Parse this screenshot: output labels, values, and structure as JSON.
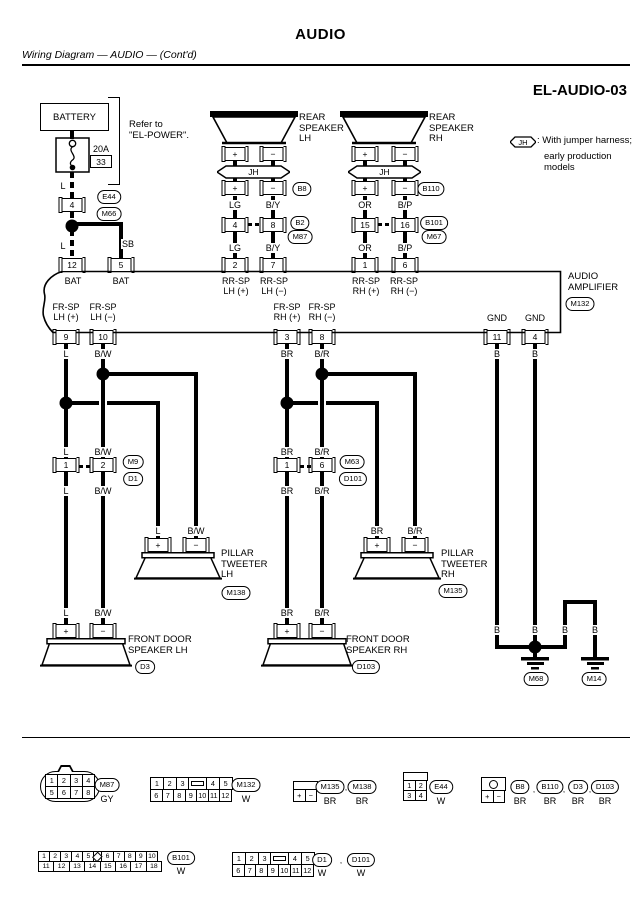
{
  "header": {
    "title": "AUDIO",
    "subtitle": "Wiring Diagram — AUDIO — (Cont'd)",
    "code": "EL-AUDIO-03"
  },
  "jh": {
    "label": "JH"
  },
  "battery": {
    "label": "BATTERY"
  },
  "graphics": {
    "wires": [
      [
        70,
        130,
        4,
        9
      ],
      [
        70,
        172,
        4,
        26,
        "vd"
      ],
      [
        70,
        212,
        4,
        14,
        "vd"
      ],
      [
        70,
        230,
        4,
        28,
        "vd"
      ],
      [
        70,
        222,
        53,
        4
      ],
      [
        119,
        222,
        4,
        36
      ],
      [
        233,
        161,
        4,
        5
      ],
      [
        271,
        161,
        4,
        5
      ],
      [
        233,
        178,
        4,
        4
      ],
      [
        271,
        178,
        4,
        4
      ],
      [
        233,
        196,
        4,
        22
      ],
      [
        271,
        196,
        4,
        22
      ],
      [
        233,
        232,
        4,
        26
      ],
      [
        271,
        232,
        4,
        26
      ],
      [
        248,
        223,
        4,
        3
      ],
      [
        255,
        223,
        4,
        3
      ],
      [
        363,
        161,
        4,
        5
      ],
      [
        403,
        161,
        4,
        5
      ],
      [
        363,
        178,
        4,
        4
      ],
      [
        403,
        178,
        4,
        4
      ],
      [
        363,
        196,
        4,
        22
      ],
      [
        403,
        196,
        4,
        22
      ],
      [
        363,
        232,
        4,
        26
      ],
      [
        403,
        232,
        4,
        26
      ],
      [
        378,
        223,
        4,
        3
      ],
      [
        385,
        223,
        4,
        3
      ],
      [
        64,
        344,
        4,
        114
      ],
      [
        101,
        344,
        4,
        114
      ],
      [
        101,
        372,
        97,
        4
      ],
      [
        194,
        372,
        4,
        166
      ],
      [
        64,
        401,
        35,
        4
      ],
      [
        107,
        401,
        53,
        4
      ],
      [
        156,
        401,
        4,
        137
      ],
      [
        64,
        472,
        4,
        152
      ],
      [
        101,
        472,
        4,
        152
      ],
      [
        79,
        465,
        4,
        3
      ],
      [
        86,
        465,
        4,
        3
      ],
      [
        285,
        344,
        4,
        114
      ],
      [
        320,
        344,
        4,
        114
      ],
      [
        318,
        372,
        99,
        4
      ],
      [
        413,
        372,
        4,
        166
      ],
      [
        285,
        401,
        33,
        4
      ],
      [
        326,
        401,
        53,
        4
      ],
      [
        375,
        401,
        4,
        137
      ],
      [
        285,
        472,
        4,
        152
      ],
      [
        320,
        472,
        4,
        152
      ],
      [
        300,
        465,
        4,
        3
      ],
      [
        307,
        465,
        4,
        3
      ],
      [
        495,
        344,
        4,
        305
      ],
      [
        533,
        344,
        4,
        301
      ],
      [
        495,
        645,
        72,
        4
      ],
      [
        563,
        600,
        4,
        45
      ],
      [
        563,
        600,
        34,
        4
      ],
      [
        593,
        600,
        4,
        57
      ],
      [
        533,
        649,
        4,
        8
      ]
    ],
    "dots": [
      [
        72,
        226
      ],
      [
        103,
        374
      ],
      [
        66,
        403
      ],
      [
        322,
        374
      ],
      [
        287,
        403
      ],
      [
        535,
        647
      ]
    ],
    "grounds": [
      [
        535,
        657
      ],
      [
        595,
        657
      ]
    ]
  },
  "pins": [
    [
      72,
      198,
      "4"
    ],
    [
      72,
      258,
      "12"
    ],
    [
      121,
      258,
      "5"
    ],
    [
      101,
      155,
      "33",
      "plain"
    ],
    [
      235,
      147,
      "+"
    ],
    [
      273,
      147,
      "−"
    ],
    [
      235,
      181,
      "+"
    ],
    [
      273,
      181,
      "−"
    ],
    [
      235,
      218,
      "4"
    ],
    [
      273,
      218,
      "8"
    ],
    [
      235,
      258,
      "2"
    ],
    [
      273,
      258,
      "7"
    ],
    [
      365,
      147,
      "+"
    ],
    [
      405,
      147,
      "−"
    ],
    [
      365,
      181,
      "+"
    ],
    [
      405,
      181,
      "−"
    ],
    [
      365,
      218,
      "15"
    ],
    [
      405,
      218,
      "16"
    ],
    [
      365,
      258,
      "1"
    ],
    [
      405,
      258,
      "6"
    ],
    [
      66,
      330,
      "9"
    ],
    [
      103,
      330,
      "10"
    ],
    [
      287,
      330,
      "3"
    ],
    [
      322,
      330,
      "8"
    ],
    [
      497,
      330,
      "11"
    ],
    [
      535,
      330,
      "4"
    ],
    [
      66,
      458,
      "1"
    ],
    [
      103,
      458,
      "2"
    ],
    [
      287,
      458,
      "1"
    ],
    [
      322,
      458,
      "6"
    ],
    [
      158,
      538,
      "+"
    ],
    [
      196,
      538,
      "−"
    ],
    [
      377,
      538,
      "+"
    ],
    [
      415,
      538,
      "−"
    ],
    [
      66,
      624,
      "+"
    ],
    [
      103,
      624,
      "−"
    ],
    [
      287,
      624,
      "+"
    ],
    [
      322,
      624,
      "−"
    ]
  ],
  "ovals": [
    {
      "x": 109,
      "y": 190,
      "t": "E44"
    },
    {
      "x": 109,
      "y": 207,
      "t": "M66"
    },
    {
      "x": 302,
      "y": 182,
      "t": "B8"
    },
    {
      "x": 300,
      "y": 216,
      "t": "B2"
    },
    {
      "x": 300,
      "y": 230,
      "t": "M87"
    },
    {
      "x": 431,
      "y": 182,
      "t": "B110"
    },
    {
      "x": 434,
      "y": 216,
      "t": "B101"
    },
    {
      "x": 434,
      "y": 230,
      "t": "M67"
    },
    {
      "x": 580,
      "y": 297,
      "t": "M132"
    },
    {
      "x": 133,
      "y": 455,
      "t": "M9"
    },
    {
      "x": 133,
      "y": 472,
      "t": "D1"
    },
    {
      "x": 352,
      "y": 455,
      "t": "M63"
    },
    {
      "x": 353,
      "y": 472,
      "t": "D101"
    },
    {
      "x": 236,
      "y": 586,
      "t": "M138"
    },
    {
      "x": 453,
      "y": 584,
      "t": "M135"
    },
    {
      "x": 145,
      "y": 660,
      "t": "D3"
    },
    {
      "x": 366,
      "y": 660,
      "t": "D103"
    },
    {
      "x": 536,
      "y": 672,
      "t": "M68"
    },
    {
      "x": 594,
      "y": 672,
      "t": "M14"
    },
    {
      "x": 107,
      "y": 778,
      "t": "M87"
    },
    {
      "x": 246,
      "y": 778,
      "t": "M132"
    },
    {
      "x": 330,
      "y": 780,
      "t": "M135"
    },
    {
      "x": 362,
      "y": 780,
      "t": "M138"
    },
    {
      "x": 441,
      "y": 780,
      "t": "E44"
    },
    {
      "x": 520,
      "y": 780,
      "t": "B8"
    },
    {
      "x": 550,
      "y": 780,
      "t": "B110"
    },
    {
      "x": 578,
      "y": 780,
      "t": "D3"
    },
    {
      "x": 605,
      "y": 780,
      "t": "D103"
    },
    {
      "x": 181,
      "y": 851,
      "t": "B101"
    },
    {
      "x": 322,
      "y": 853,
      "t": "D1"
    },
    {
      "x": 361,
      "y": 853,
      "t": "D101"
    }
  ],
  "labels": [
    [
      63,
      181,
      "L"
    ],
    [
      63,
      241,
      "L"
    ],
    [
      128,
      239,
      "SB"
    ],
    [
      92,
      144,
      "20A",
      "l"
    ],
    [
      128,
      120,
      "Refer to\n\"EL-POWER\".",
      "name"
    ],
    [
      536,
      136,
      ": With jumper harness;",
      "name"
    ],
    [
      543,
      152,
      "early production models",
      "name"
    ],
    [
      73,
      276,
      "BAT"
    ],
    [
      121,
      276,
      "BAT"
    ],
    [
      236,
      276,
      "RR-SP\nLH (+)"
    ],
    [
      274,
      276,
      "RR-SP\nLH (−)"
    ],
    [
      366,
      276,
      "RR-SP\nRH (+)"
    ],
    [
      404,
      276,
      "RR-SP\nRH (−)"
    ],
    [
      66,
      302,
      "FR-SP\nLH (+)"
    ],
    [
      103,
      302,
      "FR-SP\nLH (−)"
    ],
    [
      287,
      302,
      "FR-SP\nRH (+)"
    ],
    [
      322,
      302,
      "FR-SP\nRH (−)"
    ],
    [
      497,
      313,
      "GND"
    ],
    [
      535,
      313,
      "GND"
    ],
    [
      567,
      272,
      "AUDIO\nAMPLIFIER",
      "name"
    ],
    [
      298,
      113,
      "REAR\nSPEAKER\nLH",
      "name"
    ],
    [
      428,
      113,
      "REAR\nSPEAKER\nRH",
      "name"
    ],
    [
      220,
      549,
      "PILLAR\nTWEETER\nLH",
      "name"
    ],
    [
      440,
      549,
      "PILLAR\nTWEETER\nRH",
      "name"
    ],
    [
      127,
      635,
      "FRONT DOOR\nSPEAKER LH",
      "name"
    ],
    [
      345,
      635,
      "FRONT DOOR\nSPEAKER RH",
      "name"
    ],
    [
      235,
      200,
      "LG"
    ],
    [
      273,
      200,
      "B/Y"
    ],
    [
      235,
      243,
      "LG"
    ],
    [
      273,
      243,
      "B/Y"
    ],
    [
      365,
      200,
      "OR"
    ],
    [
      405,
      200,
      "B/P"
    ],
    [
      365,
      243,
      "OR"
    ],
    [
      405,
      243,
      "B/P"
    ],
    [
      66,
      349,
      "L"
    ],
    [
      103,
      349,
      "B/W"
    ],
    [
      66,
      447,
      "L"
    ],
    [
      103,
      447,
      "B/W"
    ],
    [
      66,
      486,
      "L"
    ],
    [
      103,
      486,
      "B/W"
    ],
    [
      66,
      608,
      "L"
    ],
    [
      103,
      608,
      "B/W"
    ],
    [
      158,
      526,
      "L"
    ],
    [
      196,
      526,
      "B/W"
    ],
    [
      287,
      349,
      "BR"
    ],
    [
      322,
      349,
      "B/R"
    ],
    [
      287,
      447,
      "BR"
    ],
    [
      322,
      447,
      "B/R"
    ],
    [
      287,
      486,
      "BR"
    ],
    [
      322,
      486,
      "B/R"
    ],
    [
      287,
      608,
      "BR"
    ],
    [
      322,
      608,
      "B/R"
    ],
    [
      377,
      526,
      "BR"
    ],
    [
      415,
      526,
      "B/R"
    ],
    [
      497,
      349,
      "B"
    ],
    [
      535,
      349,
      "B"
    ],
    [
      497,
      625,
      "B"
    ],
    [
      535,
      625,
      "B"
    ],
    [
      565,
      625,
      "B"
    ],
    [
      595,
      625,
      "B"
    ],
    [
      107,
      794,
      "GY"
    ],
    [
      246,
      794,
      "W"
    ],
    [
      330,
      796,
      "BR"
    ],
    [
      362,
      796,
      "BR"
    ],
    [
      441,
      796,
      "W"
    ],
    [
      520,
      796,
      "BR"
    ],
    [
      550,
      796,
      "BR"
    ],
    [
      578,
      796,
      "BR"
    ],
    [
      605,
      796,
      "BR"
    ],
    [
      181,
      866,
      "W"
    ],
    [
      322,
      868,
      "W"
    ],
    [
      361,
      868,
      "W"
    ],
    [
      346,
      783,
      ",",
      "sm"
    ],
    [
      534,
      785,
      ",",
      "sm"
    ],
    [
      564,
      785,
      ",",
      "sm"
    ],
    [
      590,
      785,
      ",",
      "sm"
    ],
    [
      341,
      856,
      ",",
      "sm"
    ]
  ],
  "legend": {
    "m87": {
      "row1": [
        "1",
        "2",
        "3",
        "4"
      ],
      "row2": [
        "5",
        "6",
        "7",
        "8"
      ]
    },
    "m132": {
      "row1": [
        "1",
        "2",
        "3",
        "#lock",
        "4",
        "5"
      ],
      "row2": [
        "6",
        "7",
        "8",
        "9",
        "10",
        "11",
        "12"
      ]
    },
    "m135": {
      "row": [
        "+",
        "−"
      ]
    },
    "e44": {
      "row1": [
        "1",
        "2"
      ],
      "row2": [
        "3",
        "4"
      ]
    },
    "b8": {
      "row": [
        "+",
        "−"
      ]
    },
    "b101": {
      "row1": [
        "1",
        "2",
        "3",
        "4",
        "5",
        "#dia",
        "6",
        "7",
        "8",
        "9",
        "10"
      ],
      "row2": [
        "11",
        "12",
        "13",
        "14",
        "15",
        "16",
        "17",
        "18"
      ]
    },
    "d1": {
      "row1": [
        "1",
        "2",
        "3",
        "#lock",
        "4",
        "5"
      ],
      "row2": [
        "6",
        "7",
        "8",
        "9",
        "10",
        "11",
        "12"
      ]
    }
  }
}
